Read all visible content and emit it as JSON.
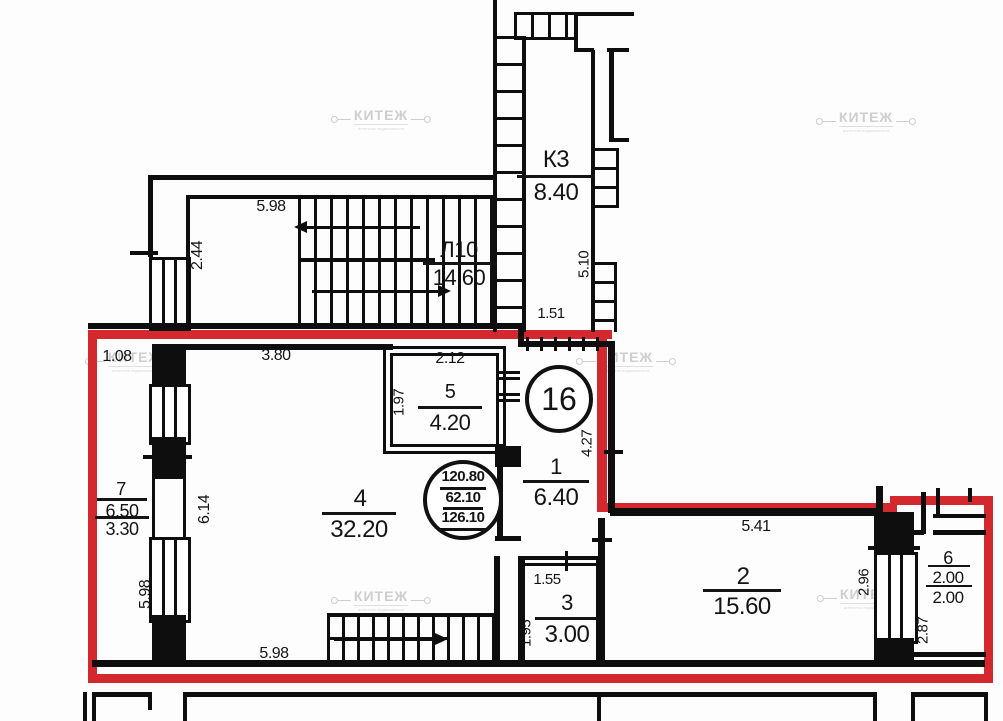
{
  "colors": {
    "boundary_red": "#d2282e",
    "walls": "#0e0e0e"
  },
  "watermark": {
    "brand": "КИТЕЖ",
    "tagline": "агентство недвижимости"
  },
  "stamp": {
    "apartment_number": "16",
    "area_total": "120.80",
    "area_living": "62.10",
    "area_with_balconies": "126.10"
  },
  "rooms": {
    "k3": {
      "number": "К3",
      "area": "8.40"
    },
    "l10": {
      "number": "Л10",
      "area": "14.60"
    },
    "r1": {
      "number": "1",
      "area": "6.40"
    },
    "r2": {
      "number": "2",
      "area": "15.60"
    },
    "r3": {
      "number": "3",
      "area": "3.00"
    },
    "r4": {
      "number": "4",
      "area": "32.20"
    },
    "r5": {
      "number": "5",
      "area": "4.20"
    },
    "r6": {
      "number": "6",
      "area_total": "2.00",
      "area_counted": "2.00"
    },
    "r7": {
      "number": "7",
      "area_total": "6.50",
      "area_counted": "3.30"
    }
  },
  "dims": {
    "d598_top": "5.98",
    "d244": "2.44",
    "d510": "5.10",
    "d151": "1.51",
    "d108": "1.08",
    "d380": "3.80",
    "d212": "2.12",
    "d197": "1.97",
    "d427": "4.27",
    "d614": "6.14",
    "d598_left": "5.98",
    "d598_bottom": "5.98",
    "d155": "1.55",
    "d195": "1.95",
    "d541": "5.41",
    "d296": "2.96",
    "d287": "2.87"
  }
}
